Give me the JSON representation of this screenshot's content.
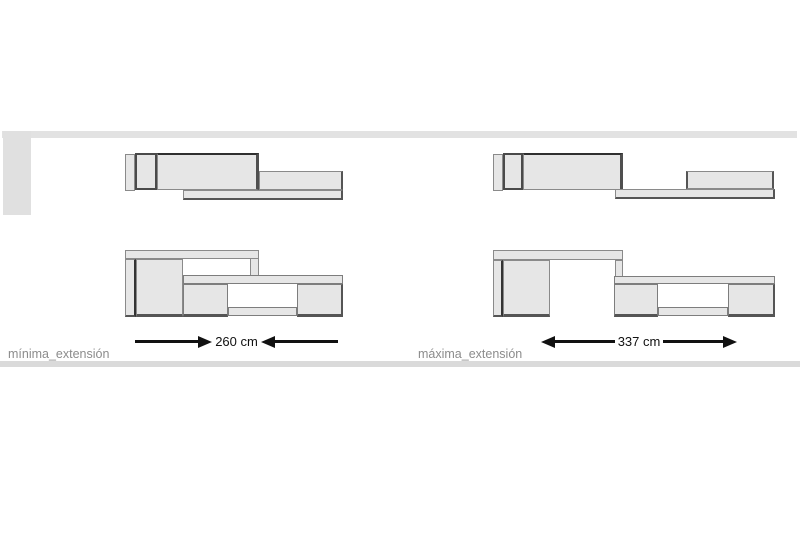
{
  "figures": {
    "minima": {
      "label": "mínima_extensión",
      "dimension": "260 cm",
      "arrow_style": "inward"
    },
    "maxima": {
      "label": "máxima_extensión",
      "dimension": "337 cm",
      "arrow_style": "outward"
    }
  },
  "colors": {
    "panel_fill": "#e6e6e6",
    "panel_border": "#8a8a8a",
    "dark_edge": "#4a4a4a",
    "band_gray": "#e2e2e2",
    "bottom_band_gray": "#dadada",
    "arrow_black": "#111111",
    "label_gray": "#8c8c8c",
    "background": "#ffffff"
  }
}
